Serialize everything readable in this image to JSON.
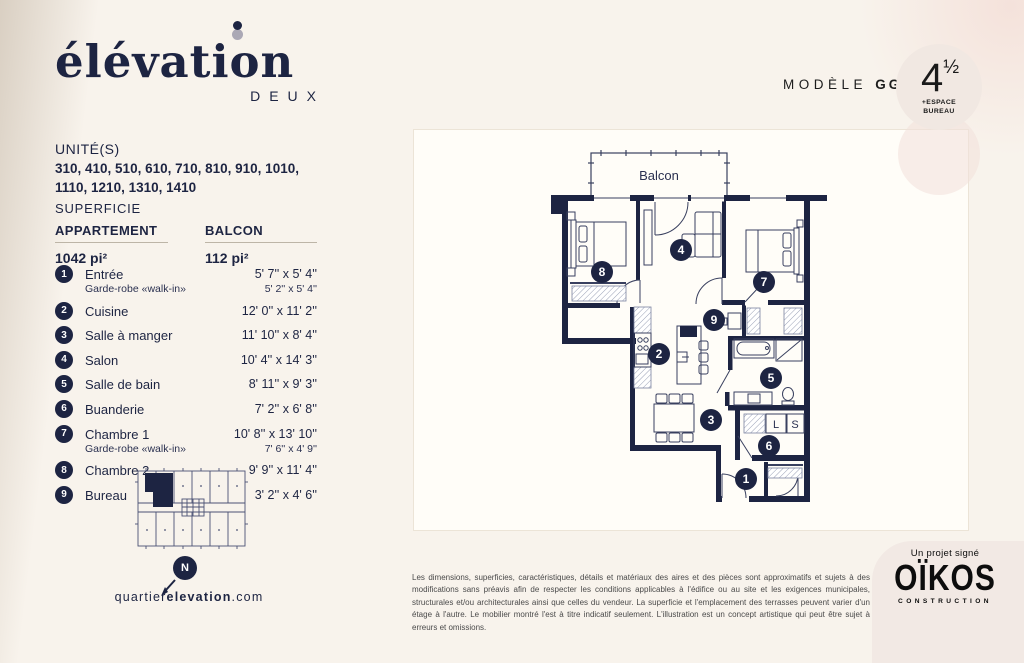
{
  "brand": {
    "wordmark": "élévation",
    "wordmark_sub": "DEUX",
    "website_prefix": "quartier",
    "website_bold": "elevation",
    "website_suffix": ".com",
    "compass_label": "N"
  },
  "units": {
    "label": "UNITÉ(S)",
    "line1": "310, 410, 510, 610, 710, 810, 910, 1010,",
    "line2": "1110, 1210, 1310, 1410"
  },
  "superficie": {
    "label": "SUPERFICIE",
    "col1_label": "APPARTEMENT",
    "col1_value": "1042 pi²",
    "col2_label": "BALCON",
    "col2_value": "112 pi²"
  },
  "rooms": [
    {
      "num": "1",
      "name": "Entrée",
      "dims": "5' 7'' x 5' 4''",
      "sub_name": "Garde-robe «walk-in»",
      "sub_dims": "5' 2'' x 5' 4''"
    },
    {
      "num": "2",
      "name": "Cuisine",
      "dims": "12' 0'' x 11' 2''"
    },
    {
      "num": "3",
      "name": "Salle à manger",
      "dims": "11' 10'' x 8' 4''"
    },
    {
      "num": "4",
      "name": "Salon",
      "dims": "10' 4'' x 14' 3''"
    },
    {
      "num": "5",
      "name": "Salle de bain",
      "dims": "8' 11'' x 9' 3''"
    },
    {
      "num": "6",
      "name": "Buanderie",
      "dims": "7' 2'' x 6' 8''"
    },
    {
      "num": "7",
      "name": "Chambre 1",
      "dims": "10' 8'' x 13' 10''",
      "sub_name": "Garde-robe «walk-in»",
      "sub_dims": "7' 6'' x 4' 9''"
    },
    {
      "num": "8",
      "name": "Chambre 2",
      "dims": "9' 9'' x 11' 4''"
    },
    {
      "num": "9",
      "name": "Bureau",
      "dims": "3' 2'' x 4' 6''"
    }
  ],
  "model": {
    "label": "MODÈLE",
    "code": "GG",
    "badge_number": "4",
    "badge_fraction": "½",
    "badge_note_line1": "+ESPACE",
    "badge_note_line2": "BUREAU"
  },
  "plan": {
    "balcony_label": "Balcon",
    "laundry_left": "L",
    "laundry_right": "S",
    "markers": [
      {
        "n": "1"
      },
      {
        "n": "2"
      },
      {
        "n": "3"
      },
      {
        "n": "4"
      },
      {
        "n": "5"
      },
      {
        "n": "6"
      },
      {
        "n": "7"
      },
      {
        "n": "8"
      },
      {
        "n": "9"
      }
    ]
  },
  "disclaimer": "Les dimensions, superficies, caractéristiques, détails et matériaux des aires et des pièces sont approximatifs et sujets à des modifications sans préavis afin de respecter les conditions applicables à l'édifice ou au site et les exigences municipales, structurales et/ou architecturales ainsi que celles du vendeur. La superficie et l'emplacement des terrasses peuvent varier d'un étage à l'autre. Le mobilier montré l'est à titre indicatif seulement. L'illustration est un concept artistique qui peut être sujet à erreurs et omissions.",
  "footer": {
    "signature": "Un projet signé",
    "company": "OÏKOS",
    "company_sub": "CONSTRUCTION"
  },
  "colors": {
    "navy": "#1d2442",
    "cream": "#f8f3ec",
    "badge_bg": "#f1e8e2",
    "pink_corner": "#f2e9e4"
  }
}
